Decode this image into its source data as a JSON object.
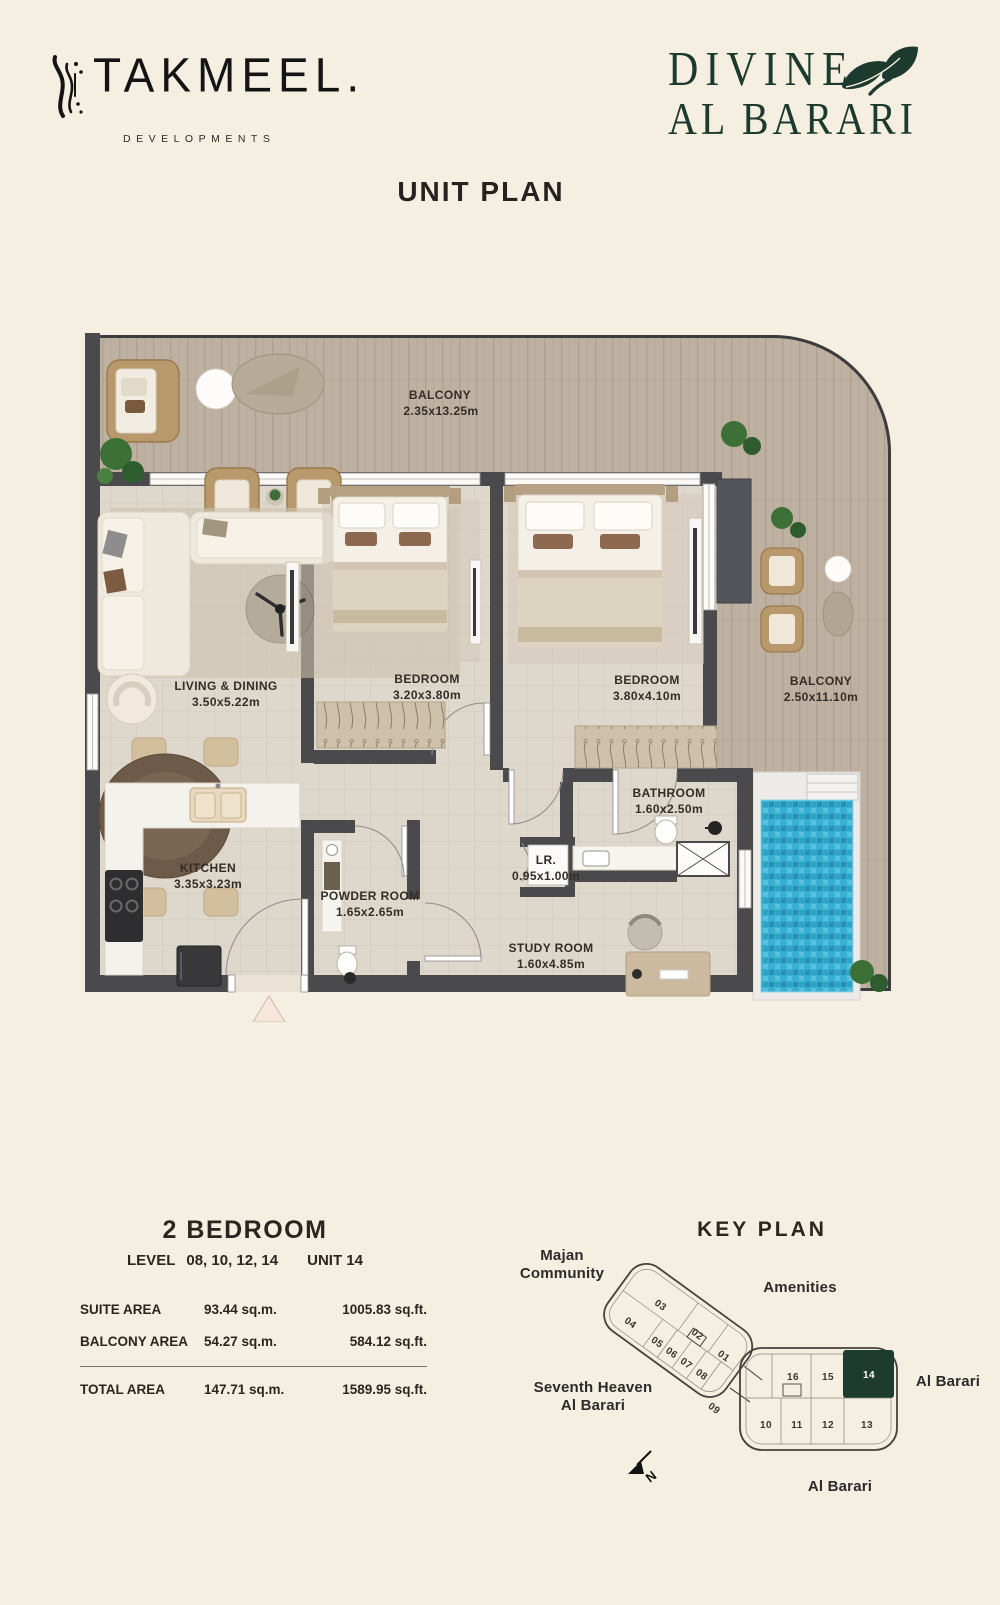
{
  "header": {
    "takmeel": {
      "name": "TAKMEEL.",
      "tagline": "DEVELOPMENTS"
    },
    "divine": {
      "line1": "DIVINE",
      "line2": "AL BARARI"
    }
  },
  "page_title": "UNIT PLAN",
  "floorplan": {
    "rooms": [
      {
        "name": "BALCONY",
        "dims": "2.35x13.25m"
      },
      {
        "name": "LIVING & DINING",
        "dims": "3.50x5.22m"
      },
      {
        "name": "BEDROOM",
        "dims": "3.20x3.80m"
      },
      {
        "name": "BEDROOM",
        "dims": "3.80x4.10m"
      },
      {
        "name": "BALCONY",
        "dims": "2.50x11.10m"
      },
      {
        "name": "KITCHEN",
        "dims": "3.35x3.23m"
      },
      {
        "name": "POWDER ROOM",
        "dims": "1.65x2.65m"
      },
      {
        "name": "BATHROOM",
        "dims": "1.60x2.50m"
      },
      {
        "name": "LR.",
        "dims": "0.95x1.00m"
      },
      {
        "name": "STUDY ROOM",
        "dims": "1.60x4.85m"
      }
    ]
  },
  "unit_info": {
    "type": "2 BEDROOM",
    "level_label": "LEVEL",
    "levels": "08, 10, 12, 14",
    "unit": "UNIT 14",
    "areas": [
      {
        "label": "SUITE AREA",
        "sqm": "93.44 sq.m.",
        "sqft": "1005.83  sq.ft."
      },
      {
        "label": "BALCONY AREA",
        "sqm": "54.27 sq.m.",
        "sqft": "584.12  sq.ft."
      },
      {
        "label": "TOTAL AREA",
        "sqm": "147.71 sq.m.",
        "sqft": "1589.95  sq.ft."
      }
    ]
  },
  "key_plan": {
    "title": "KEY PLAN",
    "labels": {
      "majan_1": "Majan",
      "majan_2": "Community",
      "amenities": "Amenities",
      "seventh_1": "Seventh Heaven",
      "seventh_2": "Al Barari",
      "al_barari_right": "Al Barari",
      "al_barari_bottom": "Al Barari",
      "north": "N"
    },
    "wing_a_units": [
      "03",
      "02",
      "01",
      "04",
      "05",
      "06",
      "07",
      "08",
      "09"
    ],
    "wing_b_top_units": [
      "16",
      "15"
    ],
    "highlighted_unit": "14",
    "wing_b_bottom_units": [
      "10",
      "11",
      "12",
      "13"
    ]
  },
  "colors": {
    "background": "#f5efe2",
    "brand_green": "#1d3a2e",
    "wall": "#4a4a4c",
    "pool_blue": "#35b0d2",
    "ink": "#262220"
  }
}
